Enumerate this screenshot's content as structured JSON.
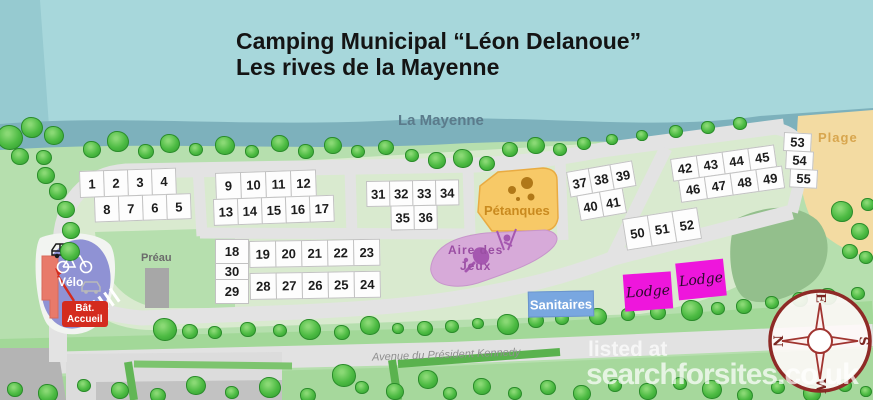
{
  "title": {
    "line1": "Camping Municipal “Léon Delanoue”",
    "line2": "Les rives de la Mayenne"
  },
  "river": {
    "label": "La Mayenne"
  },
  "avenue": {
    "label": "Avenue du Président Kennedy"
  },
  "watermark": {
    "line1": "listed at",
    "line2": "searchforsites.co.uk"
  },
  "compass": {
    "top": "E",
    "right": "S",
    "bottom": "W",
    "left": "N"
  },
  "pitches": {
    "block_a": [
      [
        "1",
        "2",
        "3",
        "4"
      ],
      [
        "8",
        "7",
        "6",
        "5"
      ]
    ],
    "block_b": [
      [
        "9",
        "10",
        "11",
        "12"
      ],
      [
        "13",
        "14",
        "15",
        "16",
        "17"
      ]
    ],
    "block_c_left": [
      [
        "18"
      ],
      [
        "30"
      ],
      [
        "29"
      ]
    ],
    "block_c": [
      [
        "19",
        "20",
        "21",
        "22",
        "23"
      ],
      [
        "28",
        "27",
        "26",
        "25",
        "24"
      ]
    ],
    "block_d": [
      [
        "31",
        "32",
        "33",
        "34"
      ],
      [
        "35",
        "36"
      ]
    ],
    "block_e": [
      [
        "37",
        "38",
        "39"
      ],
      [
        "40",
        "41"
      ]
    ],
    "block_f": [
      [
        "42",
        "43",
        "44",
        "45"
      ],
      [
        "46",
        "47",
        "48",
        "49"
      ]
    ],
    "block_g": [
      [
        "50",
        "51",
        "52"
      ]
    ],
    "block_h": [
      [
        "53"
      ],
      [
        "54"
      ],
      [
        "55"
      ]
    ]
  },
  "areas": {
    "petanques": {
      "label": "Pétanques",
      "color": "#f7c967"
    },
    "aire_des_jeux": {
      "line1": "Aire des",
      "line2": "Jeux",
      "color": "#d7aad9"
    },
    "sanitaires": {
      "label": "Sanitaires",
      "color": "#79a7e0"
    },
    "lodges": [
      {
        "label": "Lodge"
      },
      {
        "label": "Lodge"
      }
    ],
    "plage": {
      "label": "Plage",
      "color": "#f3dba2"
    },
    "velo": {
      "label": "Vélo",
      "color": "#8f92d4"
    },
    "preau": {
      "label": "Préau"
    },
    "accueil": {
      "line1": "Bât.",
      "line2": "Accueil",
      "color": "#d42b1e"
    }
  }
}
